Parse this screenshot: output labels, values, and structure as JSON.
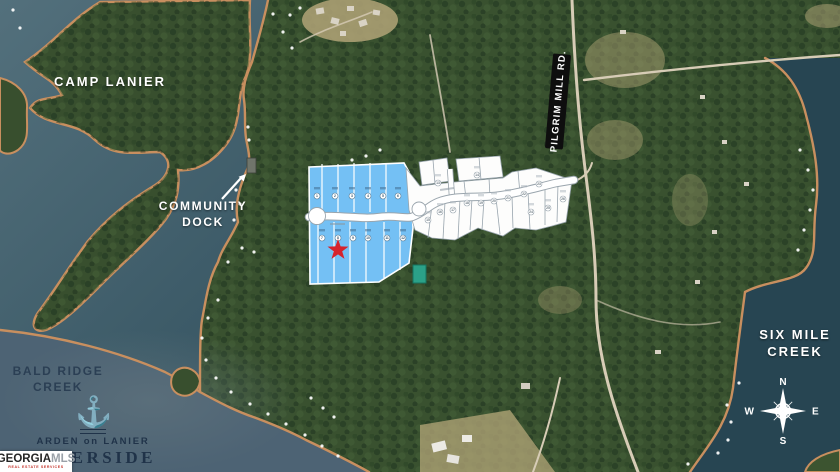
{
  "map": {
    "labels": {
      "camp_lanier": "CAMP LANIER",
      "community_dock_line1": "COMMUNITY",
      "community_dock_line2": "DOCK",
      "road_sign": "PILGRIM MILL RD.",
      "six_mile_line1": "SIX MILE",
      "six_mile_line2": "CREEK",
      "bald_ridge_line1": "BALD RIDGE",
      "bald_ridge_line2": "CREEK"
    },
    "compass": {
      "north": "N",
      "east": "E",
      "south": "S",
      "west": "W"
    }
  },
  "branding": {
    "community_name": "ARDEN on LANIER",
    "community_subname": "RIVERSIDE"
  },
  "watermark": {
    "brand": "GEORGIA",
    "brand_suffix": "MLS",
    "tagline": "REAL ESTATE SERVICES"
  },
  "plat": {
    "available_lot_numbers": [
      1,
      2,
      3,
      4,
      5,
      6,
      7,
      8,
      9,
      10,
      11,
      12
    ],
    "other_lot_numbers": [
      13,
      14,
      15,
      16,
      17,
      18,
      19,
      20,
      21,
      22,
      23,
      24,
      25,
      26
    ],
    "colors": {
      "available_fill": "#74c0f4",
      "other_fill": "#fdfdfc",
      "road_fill": "#ffffff",
      "marker_star": "#d6232c"
    }
  }
}
